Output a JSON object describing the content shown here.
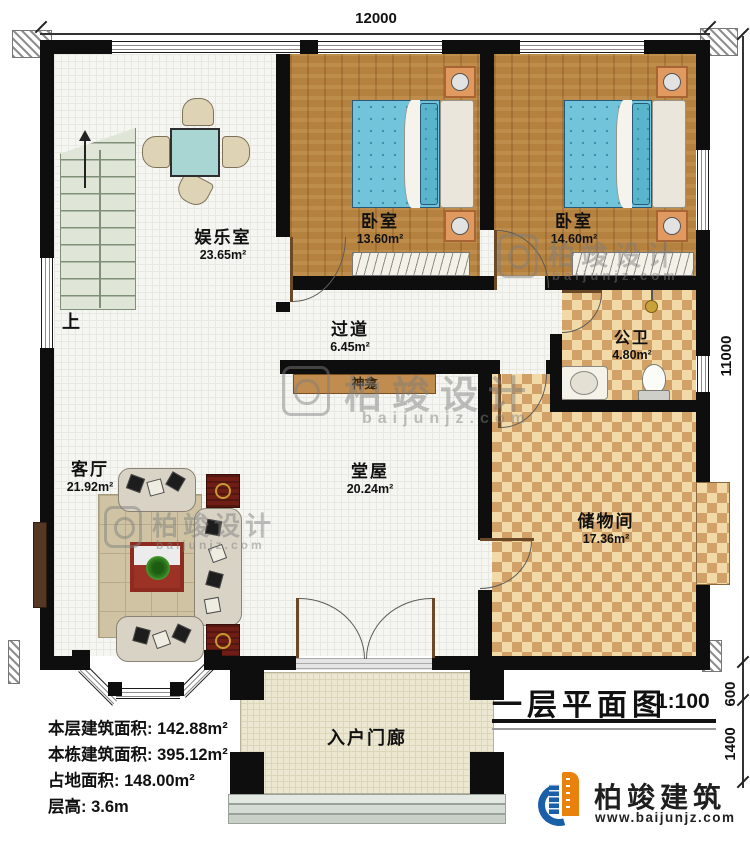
{
  "plan": {
    "dim_top": "12000",
    "dim_right": [
      "11000",
      "600",
      "1400"
    ]
  },
  "rooms": {
    "entertainment": {
      "name": "娱乐室",
      "area": "23.65m²"
    },
    "bedroom1": {
      "name": "卧室",
      "area": "13.60m²"
    },
    "bedroom2": {
      "name": "卧室",
      "area": "14.60m²"
    },
    "hallway": {
      "name": "过道",
      "area": "6.45m²"
    },
    "bathroom": {
      "name": "公卫",
      "area": "4.80m²"
    },
    "living": {
      "name": "客厅",
      "area": "21.92m²"
    },
    "hall": {
      "name": "堂屋",
      "area": "20.24m²"
    },
    "storage": {
      "name": "储物间",
      "area": "17.36m²"
    },
    "porch": {
      "name": "入户门廊"
    }
  },
  "annotations": {
    "stairs_up": "上",
    "shrine": "神龛"
  },
  "info_panel": [
    {
      "label": "本层建筑面积:",
      "value": "142.88m²"
    },
    {
      "label": "本栋建筑面积:",
      "value": "395.12m²"
    },
    {
      "label": "占地面积:",
      "value": "148.00m²"
    },
    {
      "label": "层高:",
      "value": "3.6m"
    }
  ],
  "title_block": {
    "title": "一层平面图",
    "scale": "1:100"
  },
  "brand": {
    "name": "柏竣建筑",
    "website": "www.baijunjz.com"
  },
  "watermark": {
    "text": "柏竣设计",
    "subtext": "baijunjz.com"
  },
  "colors": {
    "wall": "#0e0e0e",
    "wood_floor": "#b5813f",
    "checker_dark": "#d2a167",
    "logo_blue": "#1b5fa8",
    "logo_orange": "#e8820c",
    "table_red": "#8e2b20"
  }
}
